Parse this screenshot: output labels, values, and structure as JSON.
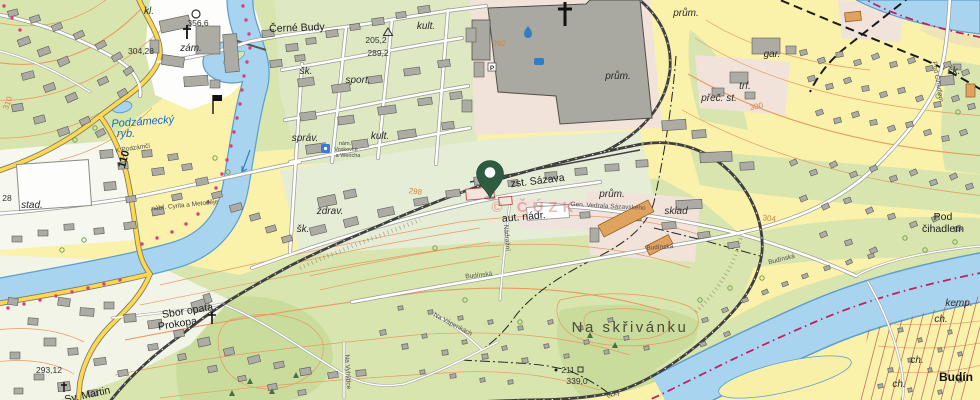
{
  "map": {
    "type": "topographic-map",
    "watermark": "© ČÚZK",
    "marker": {
      "icon": "map-pin",
      "x": 490,
      "y": 198
    },
    "colors": {
      "water": "#A8D4F0",
      "water_edge": "#5F9FCC",
      "field": "#FAF1AA",
      "green": "#D8E5AE",
      "forest": "#C9DC9C",
      "industrial": "#F2E3DA",
      "building": "#ACACA4",
      "building_orange": "#DFA35F",
      "road_major": "#FFD84D",
      "railway": "#3F3F3F",
      "contour": "#E69B60",
      "trail_dots": "#D6407E",
      "boundary": "#C02060",
      "pin": "#2E5C41"
    },
    "icons": [
      "map-pin",
      "church-cross-icon",
      "flag-icon",
      "trig-point-icon",
      "elevation-circle-icon",
      "parking-icon",
      "info-icon",
      "spot-square-icon",
      "water-drop-icon"
    ],
    "labels": [
      {
        "t": "Černé Budy",
        "x": 297,
        "y": 31,
        "c": "place",
        "r": -2
      },
      {
        "t": "kl.",
        "x": 149,
        "y": 14,
        "c": "abbr",
        "r": 0
      },
      {
        "t": "356,6",
        "x": 198,
        "y": 26,
        "c": "elev",
        "r": 0
      },
      {
        "t": "zám.",
        "x": 191,
        "y": 51,
        "c": "abbr",
        "r": 0
      },
      {
        "t": "304,28",
        "x": 141,
        "y": 54,
        "c": "elev",
        "r": 0
      },
      {
        "t": "205,2",
        "x": 376,
        "y": 43,
        "c": "elev",
        "r": 0
      },
      {
        "t": "289,2",
        "x": 378,
        "y": 56,
        "c": "elev",
        "r": 0
      },
      {
        "t": "kult.",
        "x": 426,
        "y": 29,
        "c": "abbr",
        "r": 0
      },
      {
        "t": "šk.",
        "x": 306,
        "y": 74,
        "c": "abbr",
        "r": 0
      },
      {
        "t": "sport.",
        "x": 358,
        "y": 83,
        "c": "abbr",
        "r": 0
      },
      {
        "t": "prům.",
        "x": 618,
        "y": 79,
        "c": "abbr",
        "r": 0
      },
      {
        "t": "prům.",
        "x": 686,
        "y": 16,
        "c": "abbr",
        "r": 0
      },
      {
        "t": "prům.",
        "x": 612,
        "y": 197,
        "c": "abbr",
        "r": 0
      },
      {
        "t": "gar.",
        "x": 772,
        "y": 57,
        "c": "abbr",
        "r": 0
      },
      {
        "t": "trf.",
        "x": 745,
        "y": 89,
        "c": "abbr",
        "r": 0
      },
      {
        "t": "přeč. st.",
        "x": 719,
        "y": 101,
        "c": "abbr",
        "r": 0
      },
      {
        "t": "šk.",
        "x": 954,
        "y": 74,
        "c": "abbr",
        "r": 0
      },
      {
        "t": "správ.",
        "x": 305,
        "y": 141,
        "c": "abbr",
        "r": 0
      },
      {
        "t": "kult.",
        "x": 380,
        "y": 139,
        "c": "abbr",
        "r": 0
      },
      {
        "t": "zdrav.",
        "x": 330,
        "y": 214,
        "c": "abbr",
        "r": 0
      },
      {
        "t": "šk.",
        "x": 303,
        "y": 232,
        "c": "abbr",
        "r": 0
      },
      {
        "t": "stad.",
        "x": 32,
        "y": 208,
        "c": "abbr",
        "r": 0
      },
      {
        "t": "28",
        "x": 7,
        "y": 201,
        "c": "elev",
        "r": 0
      },
      {
        "t": "Podzámecký",
        "x": 143,
        "y": 125,
        "c": "water",
        "r": -4
      },
      {
        "t": "ryb.",
        "x": 126,
        "y": 137,
        "c": "water",
        "r": 0
      },
      {
        "t": "110",
        "x": 127,
        "y": 160,
        "c": "roadnum",
        "r": -75
      },
      {
        "t": "nám.",
        "x": 345,
        "y": 145,
        "c": "tiny",
        "r": 0
      },
      {
        "t": "Voskovce",
        "x": 346,
        "y": 151,
        "c": "tiny",
        "r": 0
      },
      {
        "t": "a Wericha",
        "x": 348,
        "y": 157,
        "c": "tiny",
        "r": 0
      },
      {
        "t": "K Podzámčí",
        "x": 133,
        "y": 150,
        "c": "street",
        "r": -8
      },
      {
        "t": "zst. Sázava",
        "x": 538,
        "y": 184,
        "c": "place",
        "r": -7
      },
      {
        "t": "aut. nádr.",
        "x": 524,
        "y": 220,
        "c": "place",
        "r": -5
      },
      {
        "t": "Gen. Vedrala Sázavského",
        "x": 608,
        "y": 208,
        "c": "street",
        "r": 3
      },
      {
        "t": "Nádražní",
        "x": 505,
        "y": 238,
        "c": "street",
        "r": 85
      },
      {
        "t": "sklad",
        "x": 676,
        "y": 214,
        "c": "abbr",
        "r": 0
      },
      {
        "t": "Budínská",
        "x": 660,
        "y": 249,
        "c": "street",
        "r": -4
      },
      {
        "t": "Budínská",
        "x": 479,
        "y": 277,
        "c": "street",
        "r": -6
      },
      {
        "t": "Budínská",
        "x": 782,
        "y": 261,
        "c": "street",
        "r": -14
      },
      {
        "t": "nábř. Cyrila a Metoděje",
        "x": 185,
        "y": 207,
        "c": "street",
        "r": -6
      },
      {
        "t": "Pod Čihadlem",
        "x": 936,
        "y": 82,
        "c": "street",
        "r": 80
      },
      {
        "t": "Pod",
        "x": 943,
        "y": 220,
        "c": "place",
        "r": 0
      },
      {
        "t": "čihadlem",
        "x": 943,
        "y": 232,
        "c": "place",
        "r": 0
      },
      {
        "t": "Sbor opata",
        "x": 188,
        "y": 314,
        "c": "place",
        "r": -9
      },
      {
        "t": "Prokopa",
        "x": 178,
        "y": 327,
        "c": "place",
        "r": -9
      },
      {
        "t": "Na skřivánku",
        "x": 630,
        "y": 332,
        "c": "place-big",
        "r": 0
      },
      {
        "t": "211",
        "x": 568,
        "y": 373,
        "c": "elev",
        "r": 0
      },
      {
        "t": "339,0",
        "x": 577,
        "y": 384,
        "c": "elev",
        "r": 0
      },
      {
        "t": "293,12",
        "x": 49,
        "y": 373,
        "c": "elev",
        "r": 0
      },
      {
        "t": "Sv. Martin",
        "x": 88,
        "y": 398,
        "c": "place",
        "r": -12
      },
      {
        "t": "Budín",
        "x": 956,
        "y": 381,
        "c": "place-bold",
        "r": 0
      },
      {
        "t": "kemp.",
        "x": 959,
        "y": 306,
        "c": "abbr",
        "r": 0
      },
      {
        "t": "ch.",
        "x": 941,
        "y": 322,
        "c": "abbr",
        "r": 0
      },
      {
        "t": "ch.",
        "x": 917,
        "y": 363,
        "c": "abbr",
        "r": 0
      },
      {
        "t": "ch.",
        "x": 899,
        "y": 387,
        "c": "abbr",
        "r": 0
      },
      {
        "t": "310",
        "x": 10,
        "y": 104,
        "c": "contour",
        "r": -70
      },
      {
        "t": "292",
        "x": 499,
        "y": 46,
        "c": "contour",
        "r": 4
      },
      {
        "t": "298",
        "x": 415,
        "y": 194,
        "c": "contour",
        "r": 8
      },
      {
        "t": "300",
        "x": 757,
        "y": 109,
        "c": "contour",
        "r": -12
      },
      {
        "t": "304",
        "x": 769,
        "y": 221,
        "c": "contour",
        "r": 6
      },
      {
        "t": "Na Vyhlídce",
        "x": 346,
        "y": 372,
        "c": "street",
        "r": 87
      },
      {
        "t": "Na Vápenkách",
        "x": 452,
        "y": 326,
        "c": "street",
        "r": 28
      },
      {
        "t": "ecký",
        "x": 614,
        "y": 396,
        "c": "street",
        "r": -18
      }
    ]
  }
}
